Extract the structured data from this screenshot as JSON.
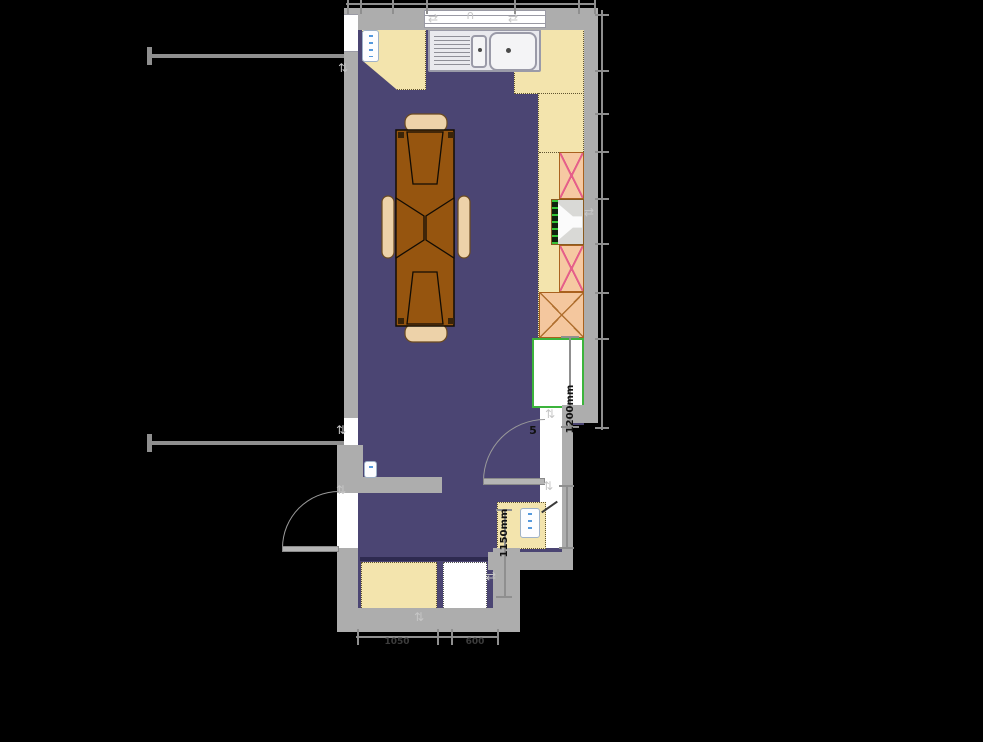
{
  "plan": {
    "dimensions": {
      "fridge_gap": "1200mm",
      "corner_run": "1150mm",
      "door_partial": "5",
      "base_unit_left": "1050",
      "base_unit_right": "600"
    },
    "icons": {
      "updown": "⇅",
      "leftright": "⇄",
      "window_arch": "∩"
    },
    "colors": {
      "canvas": "#000000",
      "floor": "#4b4573",
      "wall": "#adadad",
      "counter": "#f3e4ad",
      "wall_cabinet": "#f6c9a2",
      "wall_cabinet_cross": "#e55f8a",
      "table": "#96550f",
      "chair": "#edd2a9",
      "fridge_border": "#3cb43c",
      "radiator_mark": "#5599dd",
      "dimension_text": "#111111"
    }
  }
}
